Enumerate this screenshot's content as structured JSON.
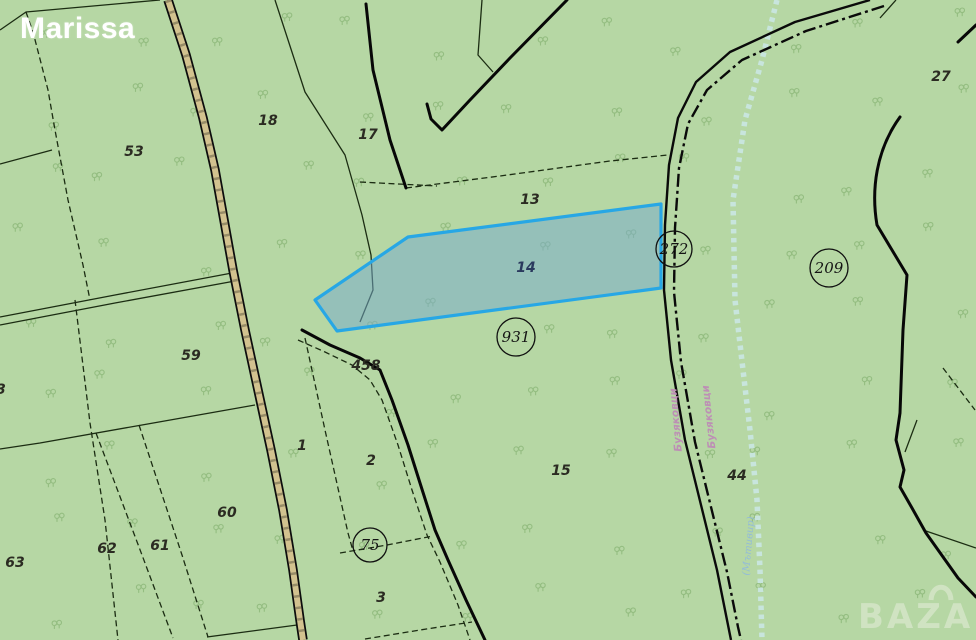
{
  "watermark": {
    "top_left": "Marissa",
    "bottom_right": "BAZAR"
  },
  "colors": {
    "background": "#b6d7a4",
    "tree": "#8eb97b",
    "thin_line": "#1b2c12",
    "thick_line": "#070707",
    "road_fill": "#d2c28f",
    "stream": "#c9e6e0",
    "selected_parcel_fill": "rgba(118,170,205,0.52)",
    "selected_parcel_border": "#27a7e5",
    "label": "#2b2b22",
    "selected_label": "#2a3a5e",
    "road_name": "#bd8fb5",
    "stream_name": "#93bcd8",
    "logo": "#d3e5c6"
  },
  "map": {
    "selected_parcel": {
      "number": "14"
    },
    "parcel_labels": [
      {
        "text": "53",
        "x": 134,
        "y": 152
      },
      {
        "text": "18",
        "x": 268,
        "y": 121
      },
      {
        "text": "17",
        "x": 368,
        "y": 135
      },
      {
        "text": "13",
        "x": 530,
        "y": 200
      },
      {
        "text": "14",
        "x": 526,
        "y": 268,
        "cls": "selected"
      },
      {
        "text": "27",
        "x": 941,
        "y": 77
      },
      {
        "text": "59",
        "x": 191,
        "y": 356
      },
      {
        "text": "1",
        "x": 302,
        "y": 446
      },
      {
        "text": "2",
        "x": 371,
        "y": 461
      },
      {
        "text": "458",
        "x": 366,
        "y": 366,
        "size": 11
      },
      {
        "text": "60",
        "x": 227,
        "y": 513
      },
      {
        "text": "61",
        "x": 160,
        "y": 546
      },
      {
        "text": "62",
        "x": 107,
        "y": 549
      },
      {
        "text": "63",
        "x": 15,
        "y": 563
      },
      {
        "text": "3",
        "x": 1,
        "y": 390
      },
      {
        "text": "3",
        "x": 381,
        "y": 598
      },
      {
        "text": "15",
        "x": 561,
        "y": 471
      },
      {
        "text": "44",
        "x": 737,
        "y": 476
      }
    ],
    "circled_labels": [
      {
        "text": "931",
        "x": 516,
        "y": 337,
        "r": 19
      },
      {
        "text": "272",
        "x": 674,
        "y": 249,
        "r": 18
      },
      {
        "text": "209",
        "x": 829,
        "y": 268,
        "r": 19
      },
      {
        "text": "75",
        "x": 370,
        "y": 545,
        "r": 17
      }
    ],
    "road_labels": [
      {
        "text": "Бузяковци",
        "x": 709,
        "y": 417,
        "rotate": -96,
        "size": 10.5
      },
      {
        "text": "Бузяковци",
        "x": 676,
        "y": 420,
        "rotate": -95,
        "size": 7.5
      }
    ],
    "stream_labels": [
      {
        "text": "(Мътивир)",
        "x": 749,
        "y": 546,
        "rotate": -85,
        "size": 10
      }
    ]
  }
}
